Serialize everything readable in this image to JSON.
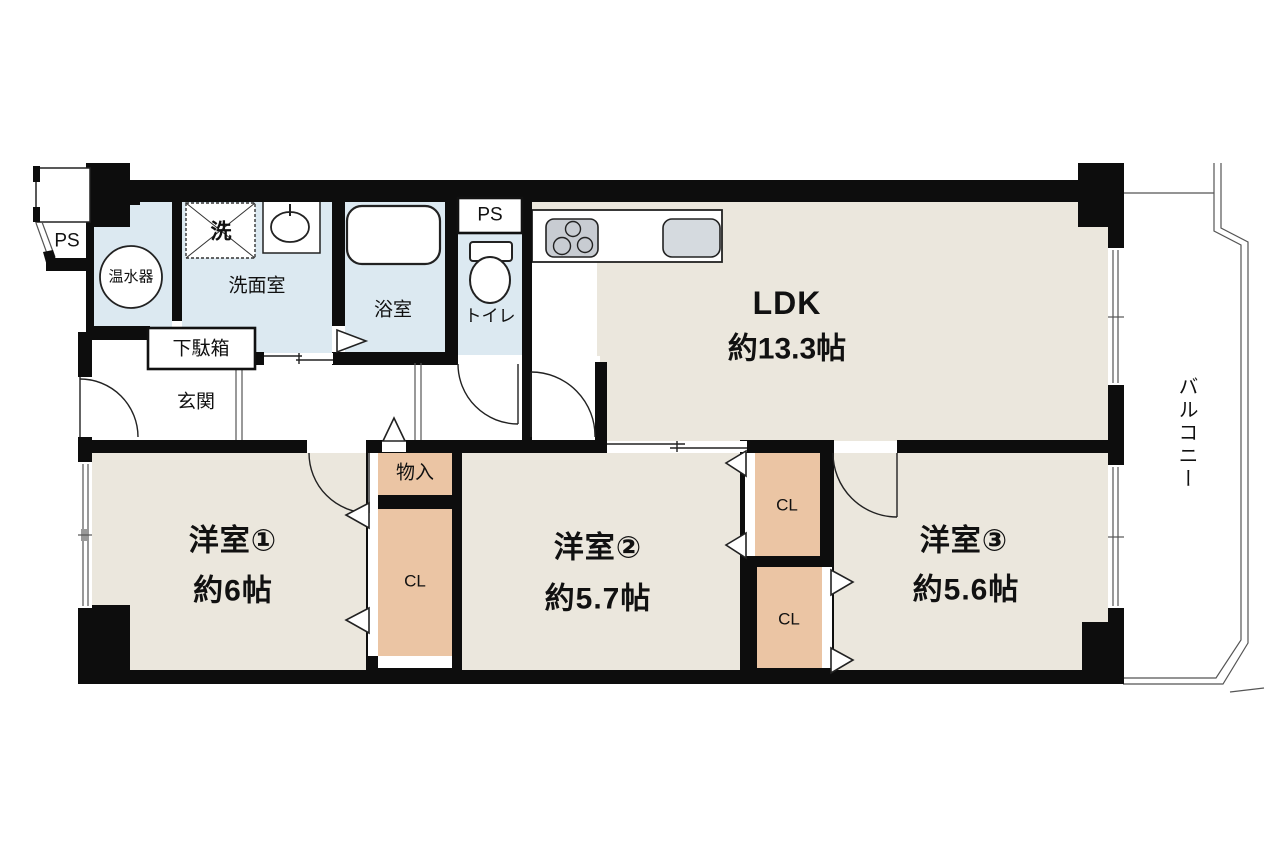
{
  "diagram_type": "apartment-floor-plan",
  "rooms": {
    "ldk": {
      "name": "LDK",
      "area": "約13.3帖"
    },
    "western1": {
      "name": "洋室①",
      "area": "約6帖"
    },
    "western2": {
      "name": "洋室②",
      "area": "約5.7帖"
    },
    "western3": {
      "name": "洋室③",
      "area": "約5.6帖"
    }
  },
  "labels": {
    "balcony": "バルコニー",
    "entrance": "玄関",
    "shoe_cabinet": "下駄箱",
    "washroom": "洗面室",
    "washing_machine": "洗",
    "water_heater": "温水器",
    "bathroom": "浴室",
    "toilet": "トイレ",
    "pipe_space_outside": "PS",
    "pipe_space_toilet": "PS",
    "storage": "物入",
    "closet": "CL"
  },
  "colors": {
    "wall": "#0d0d0d",
    "room_floor": "#ebe7dd",
    "wet_area_floor": "#dce9f1",
    "closet_fill": "#ebc5a4",
    "stove_gray": "#c8ccd2",
    "sink_gray": "#d5dadf"
  }
}
